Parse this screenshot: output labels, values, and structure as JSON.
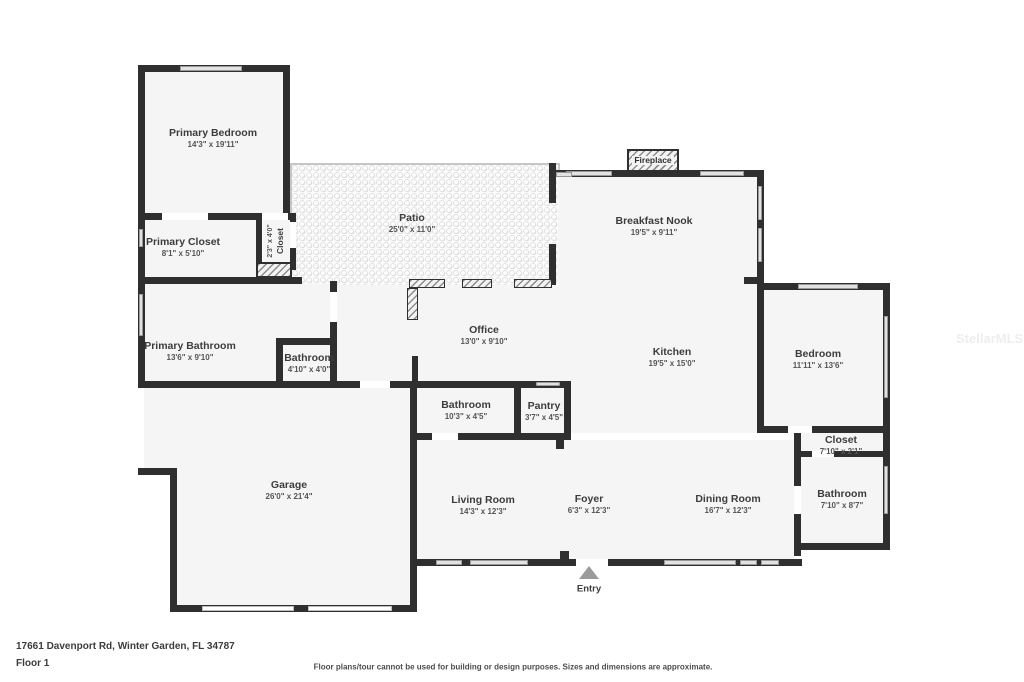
{
  "rooms": {
    "primary_bedroom": {
      "name": "Primary Bedroom",
      "dims": "14'3\" x 19'11\""
    },
    "primary_closet": {
      "name": "Primary Closet",
      "dims": "8'1\" x 5'10\""
    },
    "closet_hall": {
      "name": "Closet",
      "dims": "2'3\" x 4'0\""
    },
    "patio": {
      "name": "Patio",
      "dims": "25'0\" x 11'0\""
    },
    "breakfast_nook": {
      "name": "Breakfast Nook",
      "dims": "19'5\" x 9'11\""
    },
    "primary_bathroom": {
      "name": "Primary Bathroom",
      "dims": "13'6\" x 9'10\""
    },
    "bathroom_small": {
      "name": "Bathroom",
      "dims": "4'10\" x 4'0\""
    },
    "office": {
      "name": "Office",
      "dims": "13'0\" x 9'10\""
    },
    "kitchen": {
      "name": "Kitchen",
      "dims": "19'5\" x 15'0\""
    },
    "bedroom": {
      "name": "Bedroom",
      "dims": "11'11\" x 13'6\""
    },
    "bathroom_mid": {
      "name": "Bathroom",
      "dims": "10'3\" x 4'5\""
    },
    "pantry": {
      "name": "Pantry",
      "dims": "3'7\" x 4'5\""
    },
    "garage": {
      "name": "Garage",
      "dims": "26'0\" x 21'4\""
    },
    "living_room": {
      "name": "Living Room",
      "dims": "14'3\" x 12'3\""
    },
    "foyer": {
      "name": "Foyer",
      "dims": "6'3\" x 12'3\""
    },
    "dining_room": {
      "name": "Dining Room",
      "dims": "16'7\" x 12'3\""
    },
    "closet2": {
      "name": "Closet",
      "dims": "7'10\" x 2'1\""
    },
    "bathroom2": {
      "name": "Bathroom",
      "dims": "7'10\" x 8'7\""
    }
  },
  "fireplace": {
    "label": "Fireplace"
  },
  "entry": {
    "label": "Entry"
  },
  "footer": {
    "address": "17661 Davenport Rd, Winter Garden, FL 34787",
    "floor": "Floor 1",
    "disclaimer": "Floor plans/tour cannot be used for building or design purposes. Sizes and dimensions are approximate."
  },
  "watermark": "StellarMLS",
  "colors": {
    "wall": "#2f2f2f",
    "room_fill": "#f5f5f6",
    "window": "#e2e2e2",
    "patio_border": "#c6c6c6",
    "entry_arrow": "#9b9b9b",
    "text": "#3c3c3c"
  }
}
